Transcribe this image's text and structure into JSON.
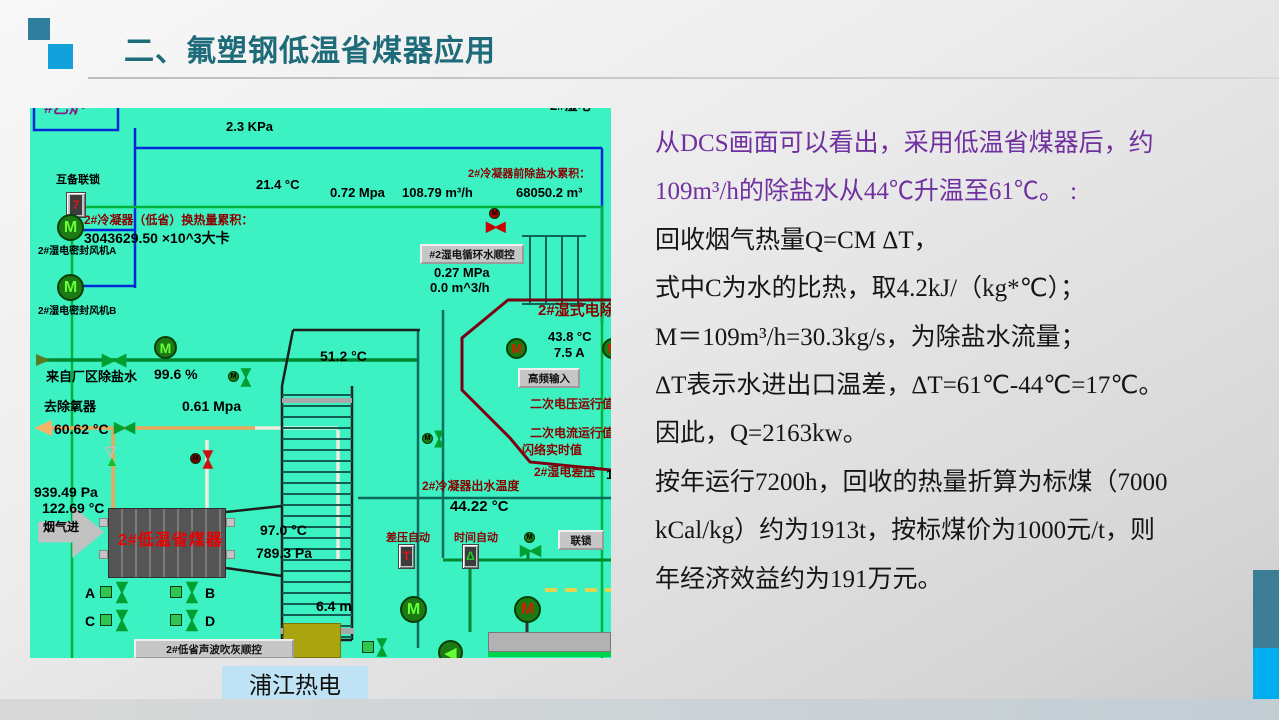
{
  "slide": {
    "title": "二、氟塑钢低温省煤器应用",
    "footer_label": "浦江热电"
  },
  "colors": {
    "title_teal": "#1e6b7a",
    "square_dark_teal": "#2f7e9d",
    "square_bright_blue": "#12a1da",
    "body_purple": "#7030a0",
    "dcs_background": "#3df2c2",
    "dcs_dark_red": "#8b0000",
    "economizer_red": "#e80000",
    "side_bar_teal": "#3b7e95",
    "side_bar_blue": "#00aeef",
    "footer_box_blue": "#bfe2f4"
  },
  "body_text": {
    "lines": [
      {
        "text": "从DCS画面可以看出，采用低温省煤器后，约",
        "color": "purple"
      },
      {
        "text": "109m³/h的除盐水从44℃升温至61℃。 :",
        "color": "purple"
      },
      {
        "text": "回收烟气热量Q=CM ΔT，",
        "color": "black"
      },
      {
        "text": "式中C为水的比热，取4.2kJ/（kg*℃）；",
        "color": "black"
      },
      {
        "text": "M＝109m³/h=30.3kg/s，为除盐水流量；",
        "color": "black"
      },
      {
        "text": "ΔT表示水进出口温差，ΔT=61℃-44℃=17℃。",
        "color": "black"
      },
      {
        "text": "因此，Q=2163kw。",
        "color": "black"
      },
      {
        "text": "按年运行7200h，回收的热量折算为标煤（7000",
        "color": "black"
      },
      {
        "text": "kCal/kg）约为1913t，按标煤价为1000元/t，则",
        "color": "black"
      },
      {
        "text": "年经济效益约为191万元。",
        "color": "black"
      }
    ]
  },
  "dcs": {
    "labels": [
      {
        "name": "boiler-label",
        "text": "#乙炉",
        "x": 14,
        "y": -8,
        "cls": "t16 cp"
      },
      {
        "name": "top-edge-cut-label",
        "text": "2#湿电",
        "x": 520,
        "y": -9,
        "cls": "t13 ck"
      },
      {
        "name": "interlock-label",
        "text": "互备联锁",
        "x": 26,
        "y": 66,
        "cls": "t11 ck"
      },
      {
        "name": "pressure-top",
        "text": "2.3 KPa",
        "x": 196,
        "y": 12,
        "cls": "t13 ck"
      },
      {
        "name": "fan-a-label",
        "text": "2#湿电密封风机A",
        "x": 8,
        "y": 138,
        "cls": "t10 ck"
      },
      {
        "name": "fan-b-label",
        "text": "2#湿电密封风机B",
        "x": 8,
        "y": 198,
        "cls": "t10 ck"
      },
      {
        "name": "temp-214",
        "text": "21.4 °C",
        "x": 226,
        "y": 70,
        "cls": "t13 ck"
      },
      {
        "name": "press-072",
        "text": "0.72 Mpa",
        "x": 300,
        "y": 78,
        "cls": "t13 ck"
      },
      {
        "name": "flow-10879",
        "text": "108.79 m³/h",
        "x": 372,
        "y": 78,
        "cls": "t13 ck"
      },
      {
        "name": "pre-desalt-total-label",
        "text": "2#冷凝器前除盐水累积：",
        "x": 438,
        "y": 60,
        "cls": "t11 cr"
      },
      {
        "name": "pre-desalt-total-value",
        "text": "68050.2 m³",
        "x": 486,
        "y": 78,
        "cls": "t13 ck"
      },
      {
        "name": "heat-total-label",
        "text": "2#冷凝器（低省）换热量累积：",
        "x": 54,
        "y": 106,
        "cls": "t12 cr"
      },
      {
        "name": "heat-total-value",
        "text": "3043629.50 ×10^3大卡",
        "x": 54,
        "y": 122,
        "cls": "t14 ck"
      },
      {
        "name": "press-027",
        "text": "0.27 MPa",
        "x": 404,
        "y": 158,
        "cls": "t13 ck"
      },
      {
        "name": "flow-00",
        "text": "0.0 m^3/h",
        "x": 400,
        "y": 173,
        "cls": "t13 ck"
      },
      {
        "name": "temp-512",
        "text": "51.2 °C",
        "x": 290,
        "y": 240,
        "cls": "t14 ck"
      },
      {
        "name": "desalt-src-label",
        "text": "来自厂区除盐水",
        "x": 16,
        "y": 262,
        "cls": "t13 ck"
      },
      {
        "name": "valve-opening",
        "text": "99.6 %",
        "x": 124,
        "y": 258,
        "cls": "t14 ck"
      },
      {
        "name": "deaerator-label",
        "text": "去除氧器",
        "x": 14,
        "y": 292,
        "cls": "t13 ck"
      },
      {
        "name": "press-061",
        "text": "0.61 Mpa",
        "x": 152,
        "y": 290,
        "cls": "t14 ck"
      },
      {
        "name": "temp-6062",
        "text": "60.62 °C",
        "x": 24,
        "y": 313,
        "cls": "t14 ck"
      },
      {
        "name": "wesp-title",
        "text": "2#湿式电除尘器",
        "x": 508,
        "y": 194,
        "cls": "t15 cr"
      },
      {
        "name": "temp-438",
        "text": "43.8 °C",
        "x": 518,
        "y": 222,
        "cls": "t13 ck"
      },
      {
        "name": "current-75",
        "text": "7.5 A",
        "x": 524,
        "y": 238,
        "cls": "t13 ck"
      },
      {
        "name": "sec-voltage-label",
        "text": "二次电压运行值",
        "x": 500,
        "y": 290,
        "cls": "t12 cr"
      },
      {
        "name": "sec-current-label",
        "text": "二次电流运行值",
        "x": 500,
        "y": 319,
        "cls": "t12 cr"
      },
      {
        "name": "flashover-label",
        "text": "闪络实时值",
        "x": 492,
        "y": 336,
        "cls": "t12 cr"
      },
      {
        "name": "wesp-dp-label",
        "text": "2#湿电差压",
        "x": 504,
        "y": 358,
        "cls": "t12 cr"
      },
      {
        "name": "wesp-dp-value",
        "text": "1",
        "x": 576,
        "y": 360,
        "cls": "t13 ck"
      },
      {
        "name": "outlet-temp-label",
        "text": "2#冷凝器出水温度",
        "x": 392,
        "y": 372,
        "cls": "t12 cr"
      },
      {
        "name": "outlet-temp-value",
        "text": "44.22 °C",
        "x": 420,
        "y": 390,
        "cls": "t15 ck"
      },
      {
        "name": "dp-auto-label",
        "text": "差压自动",
        "x": 356,
        "y": 424,
        "cls": "t11 cr"
      },
      {
        "name": "time-auto-label",
        "text": "时间自动",
        "x": 424,
        "y": 424,
        "cls": "t11 cr"
      },
      {
        "name": "press-93949",
        "text": "939.49 Pa",
        "x": 4,
        "y": 376,
        "cls": "t14 ck"
      },
      {
        "name": "temp-12269",
        "text": "122.69 °C",
        "x": 12,
        "y": 392,
        "cls": "t14 ck"
      },
      {
        "name": "flue-in-label",
        "text": "烟气进",
        "x": 13,
        "y": 413,
        "cls": "t12 ck"
      },
      {
        "name": "economizer-label",
        "text": "2#低温省煤器",
        "x": 88,
        "y": 424,
        "cls": "t16 cred2"
      },
      {
        "name": "temp-970",
        "text": "97.0 °C",
        "x": 230,
        "y": 414,
        "cls": "t14 ck"
      },
      {
        "name": "press-7893",
        "text": "789.3 Pa",
        "x": 226,
        "y": 437,
        "cls": "t14 ck"
      },
      {
        "name": "valve-a-label",
        "text": "A",
        "x": 55,
        "y": 477,
        "cls": "t14 ck"
      },
      {
        "name": "valve-b-label",
        "text": "B",
        "x": 175,
        "y": 477,
        "cls": "t14 ck"
      },
      {
        "name": "valve-c-label",
        "text": "C",
        "x": 55,
        "y": 505,
        "cls": "t14 ck"
      },
      {
        "name": "valve-d-label",
        "text": "D",
        "x": 175,
        "y": 505,
        "cls": "t14 ck"
      },
      {
        "name": "level-64",
        "text": "6.4 m",
        "x": 286,
        "y": 490,
        "cls": "t14 ck"
      }
    ],
    "buttons": [
      {
        "name": "wesp-circwater-seq-button",
        "text": "#2湿电循环水顺控",
        "x": 390,
        "y": 136,
        "w": 104,
        "h": 20
      },
      {
        "name": "hf-input-button",
        "text": "高频输入",
        "x": 488,
        "y": 260,
        "w": 62,
        "h": 20
      },
      {
        "name": "interlock-button",
        "text": "联锁",
        "x": 528,
        "y": 422,
        "w": 46,
        "h": 20
      },
      {
        "name": "economizer-soot-seq-button",
        "text": "2#低省声波吹灰顺控",
        "x": 104,
        "y": 531,
        "w": 160,
        "h": 20
      }
    ],
    "symbols": [
      {
        "name": "interlock-switch",
        "type": "switch",
        "x": 36,
        "y": 84,
        "w": 20,
        "h": 26,
        "glyph": "7",
        "gc": "#ee1111"
      },
      {
        "name": "fan-a-motor",
        "type": "motor",
        "x": 27,
        "y": 106,
        "s": 27,
        "mc": "#66ff33"
      },
      {
        "name": "fan-b-motor",
        "type": "motor",
        "x": 27,
        "y": 166,
        "s": 27,
        "mc": "#66ff33"
      },
      {
        "name": "circwater-red-valve",
        "type": "valve-mtop",
        "x": 456,
        "y": 100,
        "s": 14,
        "c": "#cc0000",
        "mcbg": "#aa0000"
      },
      {
        "name": "feedwater-motor-valve",
        "type": "motor",
        "x": 124,
        "y": 228,
        "s": 23,
        "mc": "#66ff33"
      },
      {
        "name": "main-water-valve",
        "type": "valve",
        "x": 72,
        "y": 243,
        "s": 17,
        "c": "#00a030"
      },
      {
        "name": "mid-motor-valve",
        "type": "vvalve-m",
        "x": 198,
        "y": 262,
        "s": 13,
        "c": "#00a030",
        "mcbg": "#1c7a14"
      },
      {
        "name": "deaerator-valve",
        "type": "valve",
        "x": 84,
        "y": 312,
        "s": 15,
        "c": "#00a030"
      },
      {
        "name": "feed-triangle-valve",
        "type": "trivalve",
        "x": 75,
        "y": 338,
        "s": 14
      },
      {
        "name": "feed-red-motor-valve",
        "type": "valve-mleft",
        "x": 160,
        "y": 344,
        "s": 13,
        "c": "#cc1111",
        "mcbg": "#7a0000",
        "v": 1
      },
      {
        "name": "bank-motor-valve",
        "type": "vvalve-m",
        "x": 392,
        "y": 324,
        "s": 12,
        "c": "#00a030",
        "mcbg": "#1c7a14"
      },
      {
        "name": "wesp-motor-left",
        "type": "motor",
        "x": 476,
        "y": 230,
        "s": 21,
        "mc": "#cc2200"
      },
      {
        "name": "wesp-motor-right",
        "type": "motor",
        "x": 572,
        "y": 230,
        "s": 21,
        "mc": "#cc2200"
      },
      {
        "name": "dp-auto-switch",
        "type": "switch",
        "x": 368,
        "y": 436,
        "w": 17,
        "h": 25,
        "glyph": "T",
        "gc": "#ee1111"
      },
      {
        "name": "time-auto-switch",
        "type": "switch",
        "x": 432,
        "y": 436,
        "w": 17,
        "h": 25,
        "glyph": "Δ",
        "gc": "#22cc22"
      },
      {
        "name": "interlock-motor-valve",
        "type": "valve-mtop",
        "x": 490,
        "y": 424,
        "s": 15,
        "c": "#00a030",
        "mcbg": "#1c7a14"
      },
      {
        "name": "valve-a",
        "type": "boxvalve",
        "x": 70,
        "y": 476,
        "s": 15,
        "c": "#00a030"
      },
      {
        "name": "valve-b",
        "type": "boxvalve",
        "x": 140,
        "y": 476,
        "s": 15,
        "c": "#00a030"
      },
      {
        "name": "valve-c",
        "type": "boxvalve",
        "x": 70,
        "y": 504,
        "s": 15,
        "c": "#00a030"
      },
      {
        "name": "valve-d",
        "type": "boxvalve",
        "x": 140,
        "y": 504,
        "s": 15,
        "c": "#00a030"
      },
      {
        "name": "bottomleft-pump-motor",
        "type": "motor",
        "x": 370,
        "y": 488,
        "s": 27,
        "mc": "#66ff33"
      },
      {
        "name": "bottomright-pump-motor",
        "type": "motor",
        "x": 484,
        "y": 488,
        "s": 27,
        "mc": "#cc2200"
      },
      {
        "name": "circ-pump",
        "type": "pump",
        "x": 408,
        "y": 532,
        "s": 25,
        "mc": "#66ff33"
      },
      {
        "name": "drain-valve",
        "type": "boxvalve",
        "x": 332,
        "y": 532,
        "s": 13,
        "c": "#00a030"
      }
    ]
  }
}
